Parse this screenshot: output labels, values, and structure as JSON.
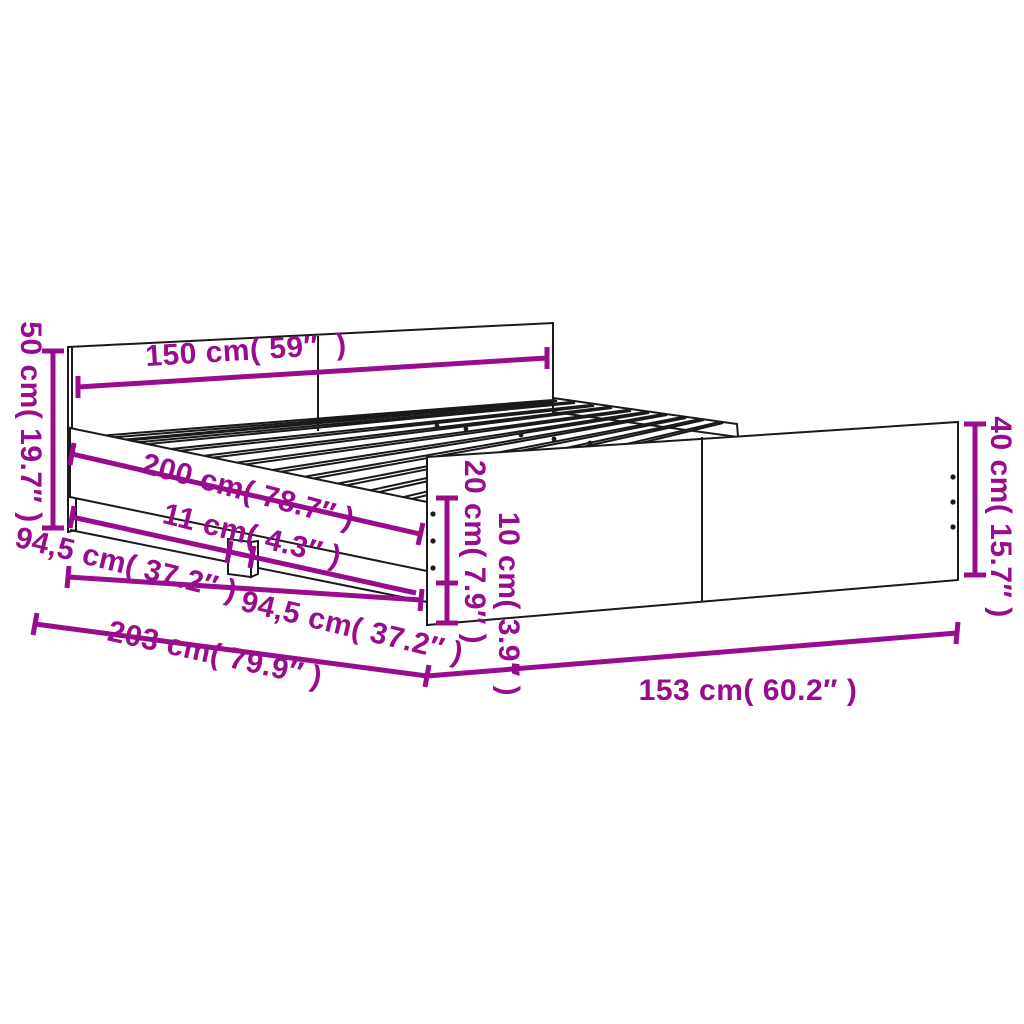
{
  "title": "Bed frame dimension diagram",
  "colors": {
    "dimension": "#990C8E",
    "outline": "#1a1a1a",
    "background": "#ffffff"
  },
  "dimensions": {
    "headboard_width": "150 cm( 59″  )",
    "headboard_height": "50 cm( 19.7″ )",
    "frame_inner_length": "200 cm( 78.7″ )",
    "leg_width": "11 cm( 4.3″ )",
    "rail_section_front": "94,5 cm( 37.2″ )",
    "rail_section_back": "94,5 cm( 37.2″ )",
    "total_length": "203 cm( 79.9″ )",
    "side_rail_height": "20 cm( 7.9″ )",
    "ground_clearance": "10 cm( 3.9″ )",
    "footboard_height": "40 cm( 15.7″ )",
    "total_width": "153 cm( 60.2″ )"
  }
}
